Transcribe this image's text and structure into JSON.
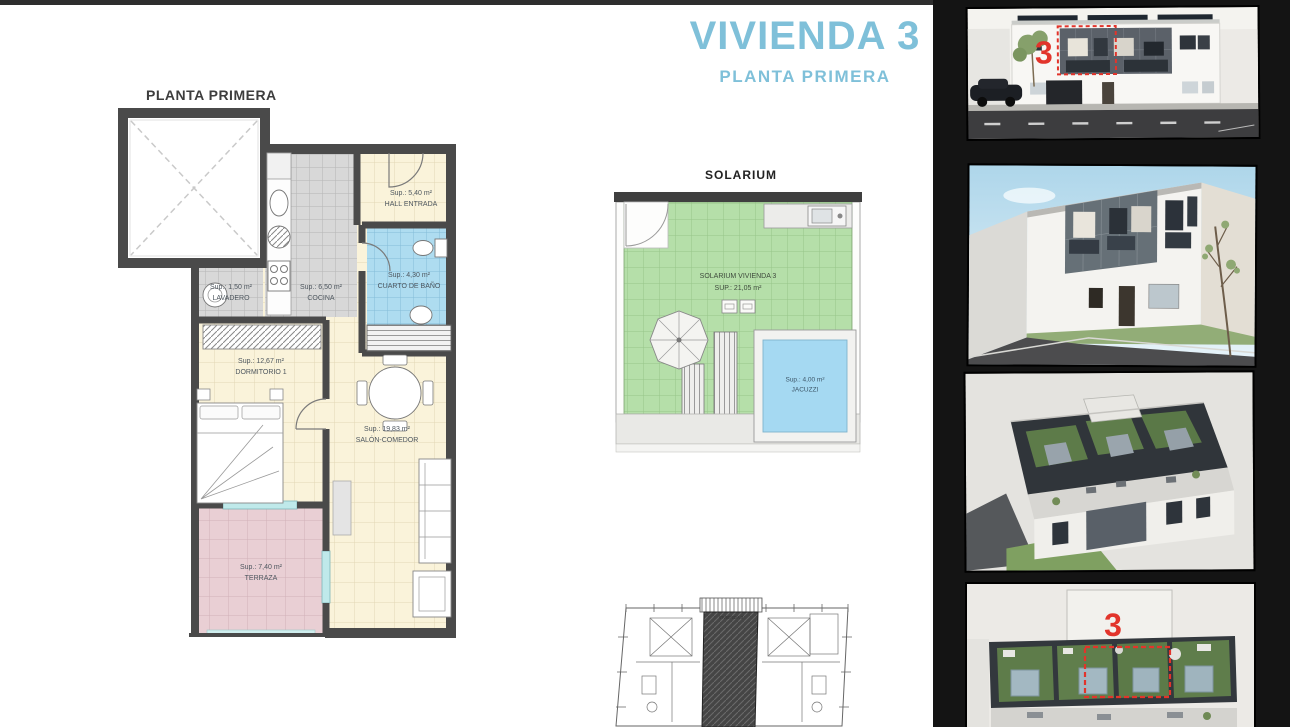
{
  "page": {
    "title": "VIVIENDA 3",
    "subtitle": "PLANTA PRIMERA"
  },
  "floor_plan": {
    "heading": "PLANTA PRIMERA",
    "rooms": {
      "hall": {
        "area": "Sup.: 5,40 m²",
        "name": "HALL ENTRADA"
      },
      "bathroom": {
        "area": "Sup.: 4,30 m²",
        "name": "CUARTO DE BAÑO"
      },
      "laundry": {
        "area": "Sup.: 1,50 m²",
        "name": "LAVADERO"
      },
      "kitchen": {
        "area": "Sup.: 6,50 m²",
        "name": "COCINA"
      },
      "bedroom": {
        "area": "Sup.: 12,67 m²",
        "name": "DORMITORIO 1"
      },
      "living": {
        "area": "Sup.: 19,83 m²",
        "name": "SALÓN-COMEDOR"
      },
      "terrace": {
        "area": "Sup.: 7,40 m²",
        "name": "TERRAZA"
      }
    }
  },
  "solarium": {
    "heading": "SOLARIUM",
    "label_name": "SOLARIUM VIVIENDA 3",
    "label_area": "SUP.: 21,05 m²",
    "jacuzzi": {
      "area": "Sup.: 4,00 m²",
      "name": "JACUZZI"
    }
  },
  "key_plan": {
    "unit_label": "VIVIENDA 3"
  },
  "renders": {
    "front_elevation_marker": "3",
    "rooftop_marker": "3"
  },
  "colors": {
    "title_blue": "#7fc0d9",
    "wall_dark": "#4a4a4a",
    "floor_cream": "#faf3da",
    "tile_gray": "#d8d8d8",
    "bath_blue": "#aedcf0",
    "terrace_pink": "#e9cfd4",
    "solarium_green": "#b5dfa9",
    "jacuzzi_blue": "#a5d9f2",
    "marker_red": "#e2342b",
    "strip_black": "#141414"
  }
}
